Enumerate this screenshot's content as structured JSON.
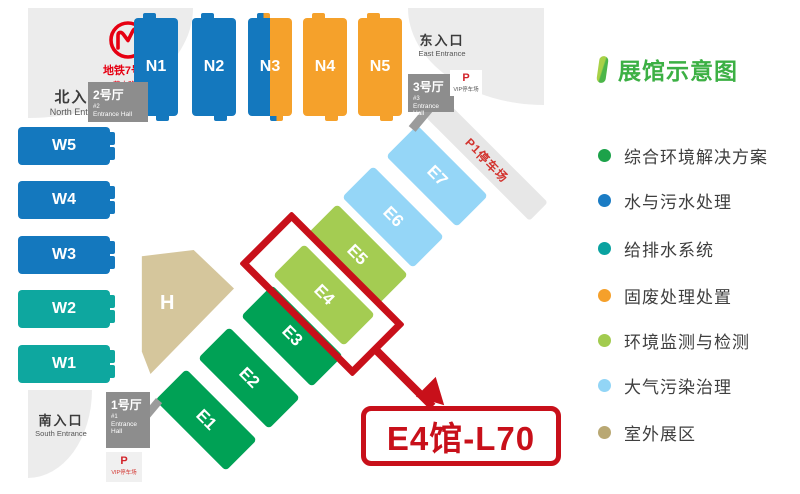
{
  "colors": {
    "hall_blue": "#1478be",
    "hall_orange": "#f5a12b",
    "hall_teal": "#0ea79f",
    "hall_green": "#00a155",
    "hall_light_green": "#a4cc52",
    "hall_light_blue": "#95d6f7",
    "outdoor_tan": "#d5c69c",
    "entrance_hall_gray": "#8d8d8d",
    "highlight_red": "#c8101a",
    "metro_red": "#e60012"
  },
  "map": {
    "metro": {
      "line_zh": "地铁7号线",
      "station_zh": "花木路站",
      "line_en": "Metro Line 7",
      "station_en": "Huamu Rd. Station"
    },
    "entrances": {
      "north": {
        "zh": "北入口",
        "en": "North Entrance"
      },
      "east": {
        "zh": "东入口",
        "en": "East Entrance"
      },
      "south": {
        "zh": "南入口",
        "en": "South Entrance"
      }
    },
    "entrance_halls": [
      {
        "zh": "2号厅",
        "num": "#2",
        "en": "Entrance Hall"
      },
      {
        "zh": "3号厅",
        "num": "#3",
        "en": "Entrance Hall"
      },
      {
        "zh": "1号厅",
        "num": "#1",
        "en": "Entrance Hall"
      }
    ],
    "parking": {
      "p": "P",
      "vip": "VIP停车场",
      "p1_bold": "P1",
      "p1_rest": "停车场"
    },
    "halls": {
      "north": [
        {
          "label": "N1"
        },
        {
          "label": "N2"
        },
        {
          "label": "N3"
        },
        {
          "label": "N4"
        },
        {
          "label": "N5"
        }
      ],
      "west": [
        {
          "label": "W5"
        },
        {
          "label": "W4"
        },
        {
          "label": "W3"
        },
        {
          "label": "W2"
        },
        {
          "label": "W1"
        }
      ],
      "diagonal": [
        {
          "label": "E1"
        },
        {
          "label": "E2"
        },
        {
          "label": "E3"
        },
        {
          "label": "E4"
        },
        {
          "label": "E5"
        },
        {
          "label": "E6"
        },
        {
          "label": "E7"
        }
      ],
      "center": {
        "label": "H"
      }
    },
    "callout": {
      "label": "E4馆-L70",
      "highlighted_hall": "E4"
    }
  },
  "legend": {
    "title": "展馆示意图",
    "items": [
      {
        "label": "综合环境解决方案",
        "color": "#1ca24a"
      },
      {
        "label": "水与污水处理",
        "color": "#1b7cc4"
      },
      {
        "label": "给排水系统",
        "color": "#0aa2a0"
      },
      {
        "label": "固废处理处置",
        "color": "#f5a02b"
      },
      {
        "label": "环境监测与检测",
        "color": "#a2cb4f"
      },
      {
        "label": "大气污染治理",
        "color": "#92d5f6"
      },
      {
        "label": "室外展区",
        "color": "#b9a873"
      }
    ]
  }
}
